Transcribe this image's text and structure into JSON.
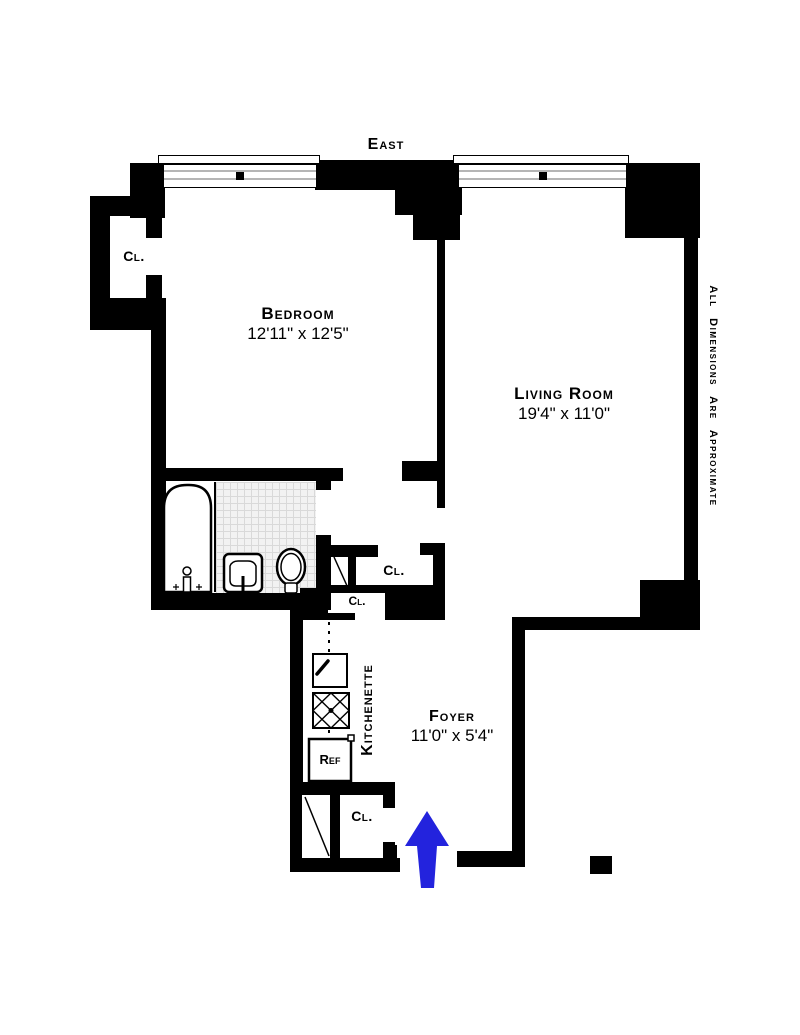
{
  "orientation_label": "East",
  "disclaimer": "All Dimensions Are Approximate",
  "rooms": {
    "bedroom": {
      "name": "Bedroom",
      "dimensions": "12'11\" x 12'5\""
    },
    "living_room": {
      "name": "Living Room",
      "dimensions": "19'4\" x 11'0\""
    },
    "foyer": {
      "name": "Foyer",
      "dimensions": "11'0\" x 5'4\""
    },
    "kitchenette": {
      "name": "Kitchenette"
    }
  },
  "closets": {
    "bedroom_closet": "Cl.",
    "hall_closet": "Cl.",
    "kitchen_closet": "Cl.",
    "entry_closet": "Cl."
  },
  "appliances": {
    "refrigerator": "Ref"
  },
  "colors": {
    "wall": "#000000",
    "entry_arrow": "#2323dd",
    "tile_background": "#f2f2f2",
    "tile_line": "#d9d9d9"
  }
}
